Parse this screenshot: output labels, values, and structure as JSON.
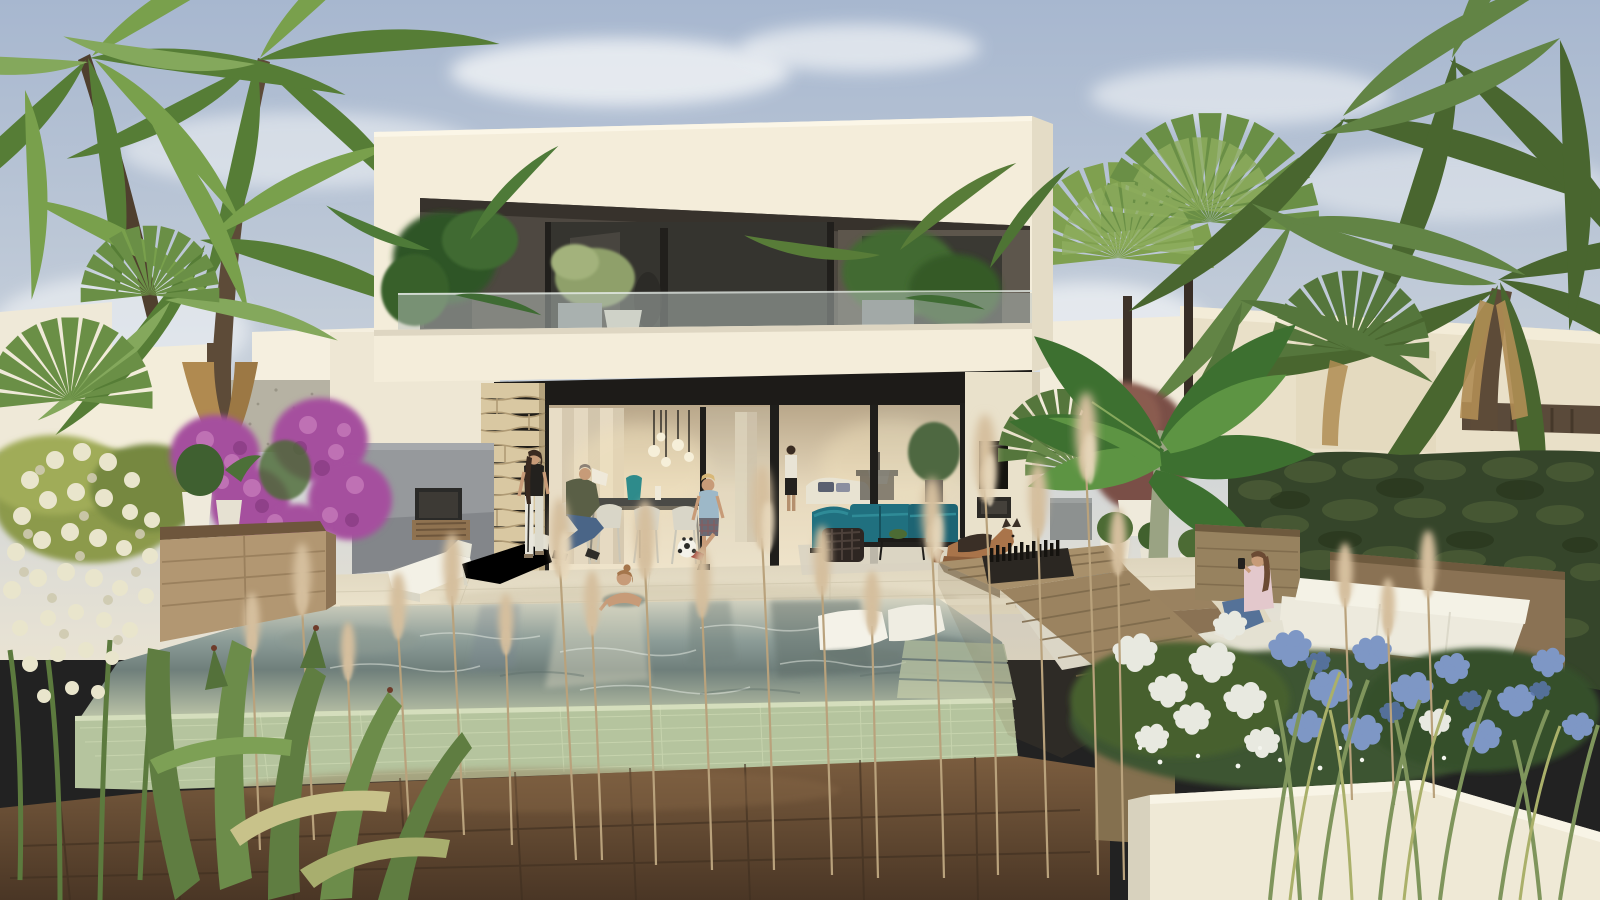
{
  "scene": {
    "description": "Photorealistic architectural rendering of a modern two-storey white villa at golden hour with an infinity edge pool, sunken fire-pit lounge, tropical landscaped garden, palm trees, seven people and a german shepherd dog",
    "time_of_day": "late afternoon",
    "subjects": [
      "two-storey modern villa",
      "upper balcony with glass railing and potted plants",
      "open sliding glass doors",
      "interior dining table with pendant globe lights",
      "teal outdoor sofa set",
      "wall mounted tv and outdoor fireplace",
      "infinity pool with two submerged white loungers",
      "woman bathing in pool",
      "two white sun loungers",
      "standing woman",
      "seated man holding white lampshade",
      "boy playing with soccer ball",
      "german shepherd dog lying down",
      "sunken lounge with white cushions and fire pit",
      "toddler with red apple",
      "man in blue t-shirt",
      "woman taking phone photo",
      "bougainvillea",
      "yucca in bloom",
      "agave",
      "pampas grass",
      "white and blue hydrangeas",
      "clipped hedge",
      "banana plant",
      "fan palms",
      "coconut palms",
      "neighbouring white houses"
    ]
  },
  "colors": {
    "sky_top": "#a7b7cf",
    "sky_mid": "#c6cfda",
    "horizon": "#e9e3d3",
    "cloud": "#f3f5f7",
    "villa_white": "#f4edda",
    "villa_side": "#e4dcc6",
    "recess_dark": "#4e4841",
    "window_glass": "#35342f",
    "awning_dark": "#1d1b18",
    "stone_wall": "#d9c8a2",
    "stone_joint": "#a8936d",
    "interior_warm": "#e6d8bc",
    "terrace": "#e4dcc5",
    "grey_wall": "#96999c",
    "pool_far": "#d5d4c2",
    "pool_mid": "#8d9d98",
    "pool_deep": "#6f7f7b",
    "pool_near": "#bcc4a8",
    "tile_mosaic": "#b5c49e",
    "deck_top": "#7b5d3f",
    "deck_bottom": "#4a3625",
    "planter_wood": "#b29772",
    "lounge_wood": "#9b8360",
    "cushion_white": "#edeadd",
    "teal_sofa": "#20707f",
    "hedge_green": "#35452a",
    "palm_green": "#567d36",
    "palm_light": "#79a04c",
    "banana_green": "#3d7030",
    "bougainvillea": "#a5509e",
    "hydrangea_white": "#e8e9e0",
    "hydrangea_blue": "#7e97c5",
    "pampas": "#d5bf9e",
    "yucca_white": "#e9e5cc",
    "grass_green": "#7f955c",
    "dog_tan": "#a9744a",
    "skin": "#c79b78"
  },
  "people": [
    {
      "label": "woman standing on terrace"
    },
    {
      "label": "man seated at dining table"
    },
    {
      "label": "boy with soccer ball"
    },
    {
      "label": "woman in pool"
    },
    {
      "label": "toddler in sunken lounge"
    },
    {
      "label": "man in blue t-shirt in sunken lounge"
    },
    {
      "label": "woman taking photo with phone"
    }
  ],
  "animals": [
    {
      "label": "german shepherd dog"
    }
  ]
}
